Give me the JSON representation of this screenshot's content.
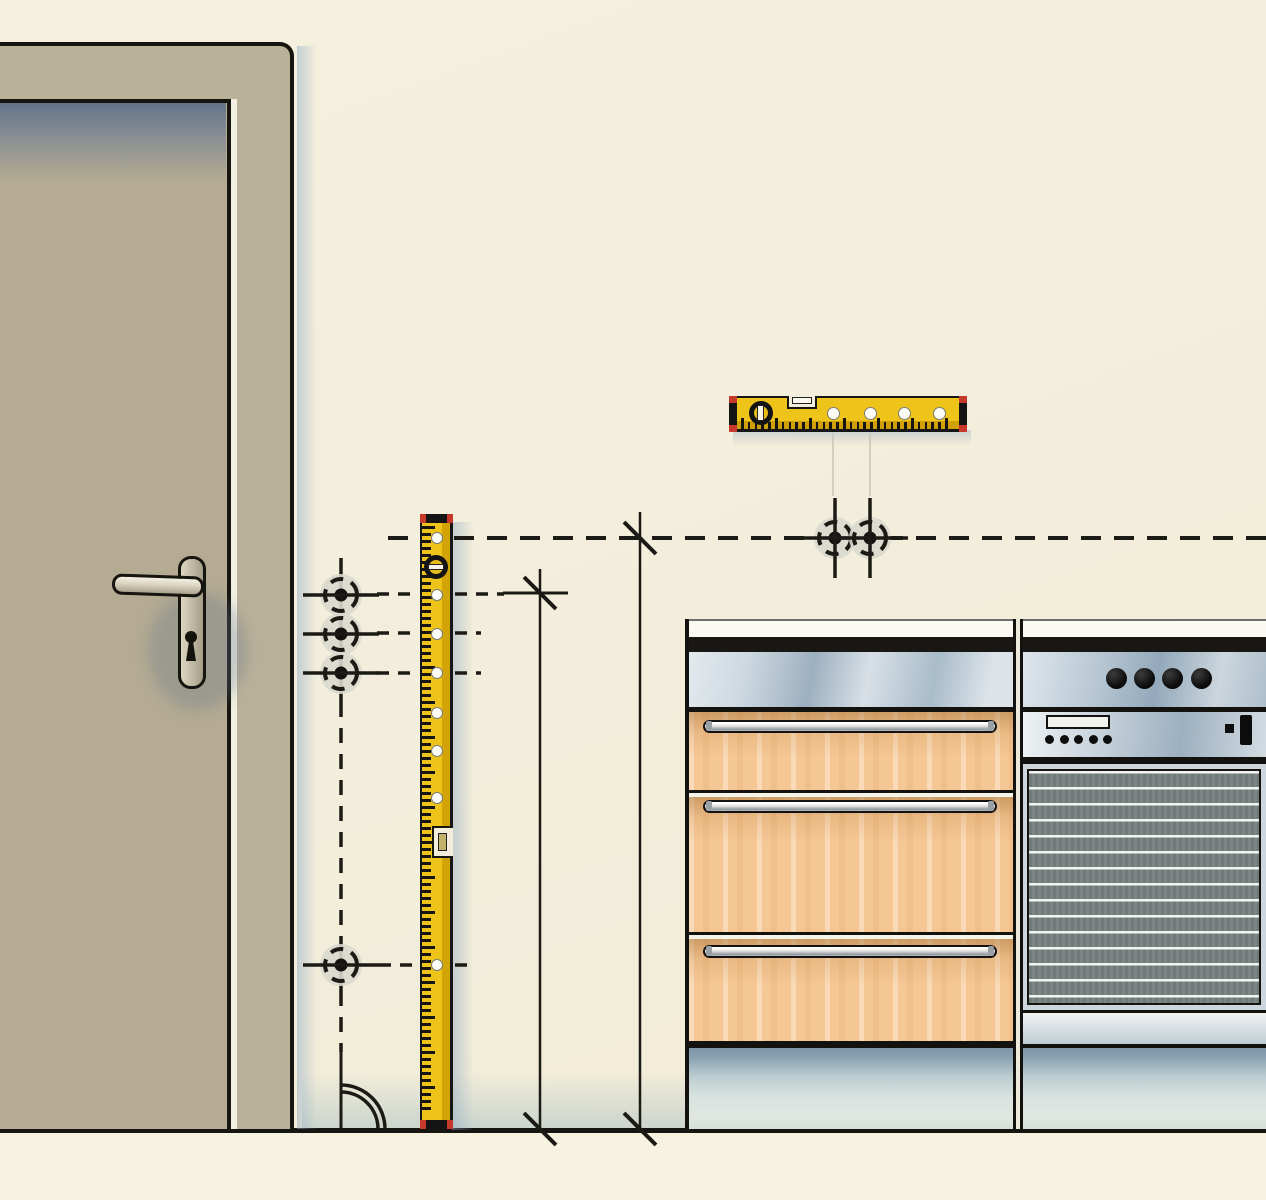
{
  "meta": {
    "subject": "kitchen-installation-marking-illustration",
    "visible_text": "none"
  },
  "palette": {
    "wall": "#f3eedb",
    "floor": "#f8f2e0",
    "line_black": "#171511",
    "door_frame": "#bab199",
    "door": "#b4ab92",
    "door_top_shadow": "#62748a",
    "shadow_blue": "#94aec6",
    "level_yellow": "#eec31a",
    "level_yellow_dark": "#d2a408",
    "level_cap_red": "#c5382a",
    "wood": "#f5c795",
    "wood_shade": "#a67134",
    "steel_light": "#e3eaee",
    "steel_dark": "#93a9bb",
    "oven_door_gray": "#76807e",
    "oven_stripe": "#f8faf8",
    "plinth_dark": "#7b94a9",
    "plinth_light": "#d5dfd9",
    "marker_fill": "#d9d8ce",
    "guide_faint": "#c9c4b5"
  },
  "scene": {
    "floor_y": 1129,
    "lines": [
      {
        "x1": 388,
        "y1": 538,
        "x2": 418,
        "y2": 538,
        "w": 4,
        "dash": "20 13"
      },
      {
        "x1": 454,
        "y1": 538,
        "x2": 1266,
        "y2": 538,
        "w": 4,
        "dash": "20 13"
      },
      {
        "x1": 640,
        "y1": 512,
        "x2": 640,
        "y2": 1129,
        "w": 2.5
      },
      {
        "x1": 540,
        "y1": 569,
        "x2": 540,
        "y2": 1129,
        "w": 2.5
      },
      {
        "x1": 503,
        "y1": 593,
        "x2": 568,
        "y2": 593,
        "w": 3
      },
      {
        "x1": 377,
        "y1": 594,
        "x2": 416,
        "y2": 594,
        "w": 3.5,
        "dash": "12 9"
      },
      {
        "x1": 455,
        "y1": 594,
        "x2": 504,
        "y2": 594,
        "w": 3.5,
        "dash": "12 9"
      },
      {
        "x1": 377,
        "y1": 633,
        "x2": 416,
        "y2": 633,
        "w": 3.5,
        "dash": "12 9"
      },
      {
        "x1": 455,
        "y1": 633,
        "x2": 481,
        "y2": 633,
        "w": 3.5,
        "dash": "12 9"
      },
      {
        "x1": 377,
        "y1": 673,
        "x2": 416,
        "y2": 673,
        "w": 3.5,
        "dash": "12 9"
      },
      {
        "x1": 455,
        "y1": 673,
        "x2": 481,
        "y2": 673,
        "w": 3.5,
        "dash": "12 9"
      },
      {
        "x1": 379,
        "y1": 965,
        "x2": 418,
        "y2": 965,
        "w": 3.5,
        "dash": "12 9"
      },
      {
        "x1": 455,
        "y1": 965,
        "x2": 474,
        "y2": 965,
        "w": 3.5,
        "dash": "12 9"
      },
      {
        "x1": 341,
        "y1": 558,
        "x2": 341,
        "y2": 702,
        "w": 3.5
      },
      {
        "x1": 341,
        "y1": 702,
        "x2": 341,
        "y2": 942,
        "w": 3.5,
        "dash": "15 11"
      },
      {
        "x1": 341,
        "y1": 942,
        "x2": 341,
        "y2": 991,
        "w": 3.5
      },
      {
        "x1": 341,
        "y1": 991,
        "x2": 341,
        "y2": 1052,
        "w": 3.5,
        "dash": "15 11"
      },
      {
        "x1": 341,
        "y1": 1052,
        "x2": 341,
        "y2": 1128,
        "w": 3
      },
      {
        "x1": 833,
        "y1": 433,
        "x2": 833,
        "y2": 496,
        "w": 1.5,
        "c": "#c9c4b5"
      },
      {
        "x1": 870,
        "y1": 433,
        "x2": 870,
        "y2": 496,
        "w": 1.5,
        "c": "#c9c4b5"
      }
    ],
    "dimension_ticks": [
      {
        "x": 640,
        "y": 538
      },
      {
        "x": 540,
        "y": 593
      },
      {
        "x": 540,
        "y": 1129
      },
      {
        "x": 640,
        "y": 1129
      }
    ],
    "drill_markers": [
      {
        "cx": 341,
        "cy": 595,
        "arms": "h"
      },
      {
        "cx": 341,
        "cy": 634,
        "arms": "h"
      },
      {
        "cx": 341,
        "cy": 673,
        "arms": "h"
      },
      {
        "cx": 341,
        "cy": 965,
        "arms": "h"
      },
      {
        "cx": 835,
        "cy": 538,
        "arms": "hv"
      },
      {
        "cx": 870,
        "cy": 538,
        "arms": "hv"
      }
    ],
    "marker_style": {
      "r_outer": 21,
      "r_ring": 16,
      "r_dot": 6.5,
      "ring_dash": "13 8.5",
      "arm": 38
    },
    "door_swing_arcs": [
      "M 341 1085 A 44 44 0 0 1 385 1129",
      "M 341 1092 A 37 37 0 0 1 378 1129"
    ],
    "vertical_level": {
      "x": 420,
      "y": 514,
      "w": 33,
      "h": 615,
      "holes_y": [
        538,
        595,
        634,
        673,
        713,
        751,
        798,
        965
      ],
      "hole_cx": 437,
      "hole_r": 6,
      "vial_circle_cy": 567,
      "vial_notch_y": 826,
      "tick_count": 84,
      "tick_spacing": 7,
      "tick_start": 12
    },
    "horizontal_level": {
      "x": 729,
      "y": 396,
      "w": 238,
      "h": 36,
      "holes_x": [
        833,
        870,
        904,
        939
      ],
      "hole_cy": 413,
      "hole_r": 6.5,
      "vial_circle_cx": 761,
      "vial_notch_x": 787,
      "tick_count": 31,
      "tick_spacing": 6.8,
      "tick_start": 12
    },
    "oven": {
      "knobs_cx": [
        1116,
        1144,
        1172,
        1201
      ],
      "knobs_cy": 678,
      "knob_r": 10.5,
      "dots_cx": [
        1049,
        1064,
        1078,
        1093,
        1107
      ],
      "dots_cy": 739,
      "dot_r": 4.5
    },
    "cabinet": {
      "drawers": [
        {
          "top": 712,
          "height": 81,
          "handle_y": 720
        },
        {
          "top": 797,
          "height": 138,
          "handle_y": 800
        },
        {
          "top": 939,
          "height": 105,
          "handle_y": 945
        }
      ],
      "gaps_y": [
        793,
        935
      ]
    }
  }
}
